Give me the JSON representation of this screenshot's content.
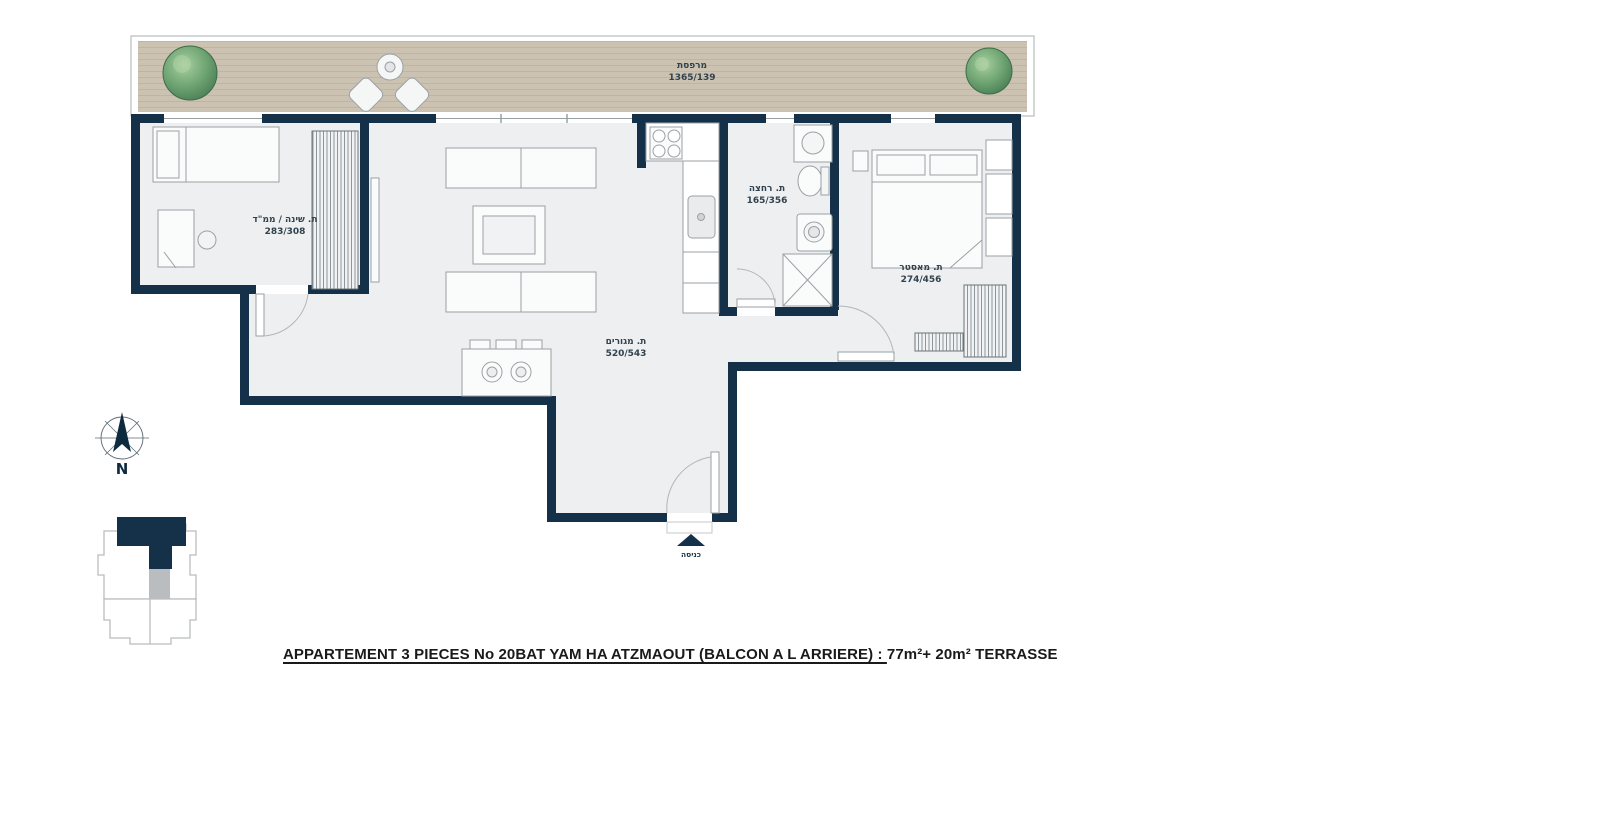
{
  "meta": {
    "type": "architectural-floorplan"
  },
  "title": {
    "underlined": "APPARTEMENT 3 PIECES No 20BAT YAM HA ATZMAOUT (BALCON A L ARRIERE) : ",
    "rest": "77m²+ 20m² TERRASSE"
  },
  "compass": {
    "north_label": "N"
  },
  "entrance": {
    "label": "כניסה"
  },
  "rooms": [
    {
      "id": "terrace",
      "label": "מרפסת",
      "dims": "1365/139"
    },
    {
      "id": "bedroom-mamad",
      "label": "ת. שינה / ממ\"ד",
      "dims": "283/308"
    },
    {
      "id": "living-room",
      "label": "ת. מגורים",
      "dims": "520/543"
    },
    {
      "id": "bathroom",
      "label": "ת. רחצה",
      "dims": "165/356"
    },
    {
      "id": "master-bedroom",
      "label": "ת. מאסטר",
      "dims": "274/456"
    }
  ],
  "icons": [
    "tree-icon",
    "compass-icon",
    "entrance-arrow-icon",
    "keyplan-icon"
  ],
  "colors": {
    "wall": "#15314a",
    "floor": "#edeff0",
    "deck": "#ccc2b1",
    "tree": "#5d9268",
    "label_text": "#31424e",
    "title_text": "#1a1a1a"
  }
}
